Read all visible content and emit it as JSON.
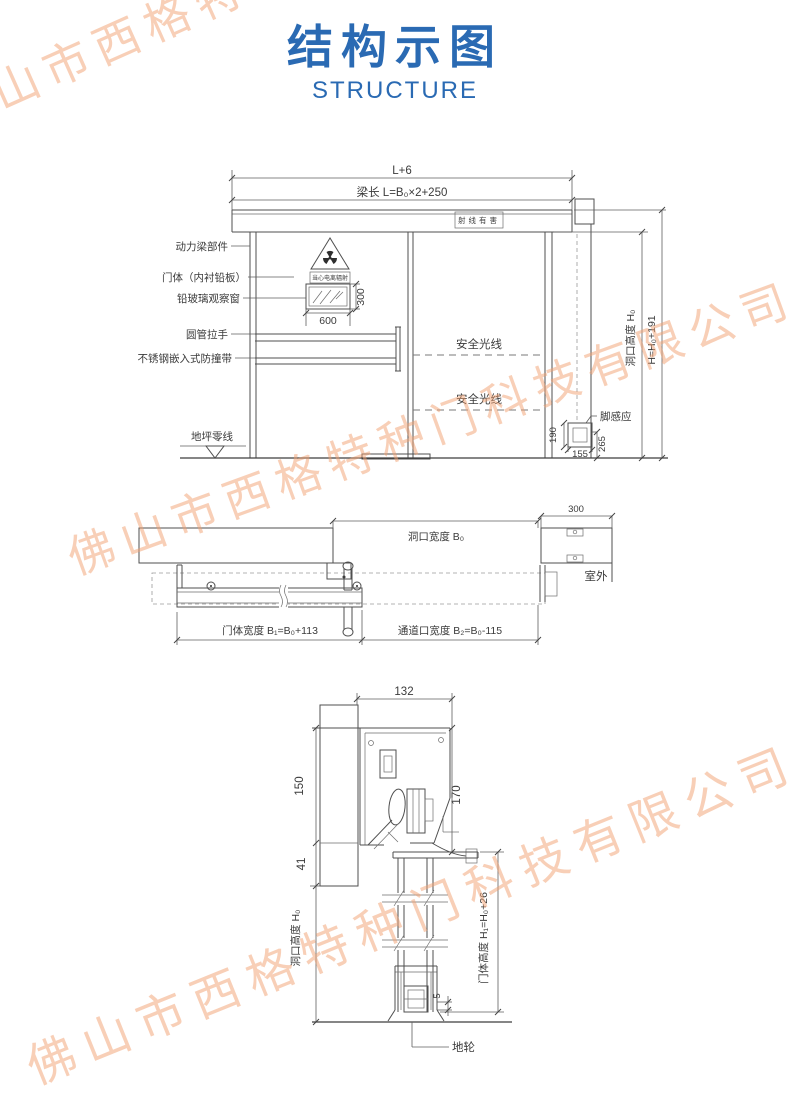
{
  "header": {
    "title": "结构示图",
    "subtitle": "STRUCTURE",
    "accent_color": "#2a6ab3"
  },
  "watermark": {
    "text": "佛山市西格特种门科技有限公司",
    "color": "#f2a070"
  },
  "elevation": {
    "dim_total": "L+6",
    "dim_beam": "梁长 L=B₀×2+250",
    "radiation_box": "射线有害",
    "radiation_caption": "当心电离辐射",
    "labels": {
      "power_beam": "动力梁部件",
      "door_body": "门体（内衬铅板）",
      "lead_glass": "铅玻璃观察窗",
      "handle": "圆管拉手",
      "bumper": "不锈钢嵌入式防撞带",
      "floor_zero": "地坪零线",
      "safety1": "安全光线",
      "safety2": "安全光线",
      "foot_sensor": "脚感应"
    },
    "dims": {
      "window_w": "600",
      "window_h": "300",
      "sensor_h": "190",
      "sensor_w": "155",
      "sensor_off": "265",
      "opening_h": "洞口高度 H₀",
      "total_h": "H=H₀+191"
    }
  },
  "plan": {
    "dims": {
      "opening_w": "洞口宽度 B₀",
      "overlap": "300",
      "door_w": "门体宽度 B₁=B₀+113",
      "passage_w": "通道口宽度 B₂=B₀-115"
    },
    "labels": {
      "outdoor": "室外"
    }
  },
  "section": {
    "dims": {
      "depth": "132",
      "track_h": "150",
      "lintel_overlap": "41",
      "head_h": "170",
      "floor_gap": "5",
      "opening_h": "洞口高度 H₀",
      "door_h": "门体高度 H₁=H₀+26"
    },
    "labels": {
      "floor_wheel": "地轮"
    }
  }
}
